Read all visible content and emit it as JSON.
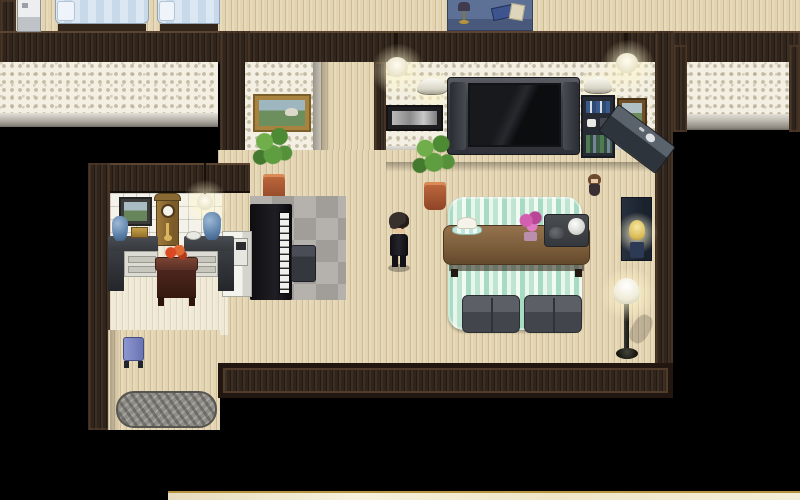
{
  "app": {
    "type": "rpg-maker-style game screenshot",
    "view": "top-down interior of a house, player character standing in living room",
    "visible_text": "none"
  },
  "palette": {
    "void": "#000000",
    "wood_floor": "#e4d5b2",
    "pale_floor": "#efe8d4",
    "dark_wall": "#31241a",
    "mosaic_tile": "#f3efe2",
    "white_tile": "#f4f2ea",
    "rug_green": "#bfe4d0",
    "rug_gray": "#8f8d87",
    "marble": "#f2ebd5",
    "lamp_glow": "#fff7cd",
    "bed_blue": "#d8e5f0",
    "bench_blue": "#7b85c4",
    "table_brown": "#7d5f3f",
    "flower_pink": "#d35fb0"
  },
  "rooms": {
    "top_bedroom": {
      "name": "bedroom strip (top edge)",
      "furniture": [
        "refrigerator",
        "bed",
        "bed",
        "blue desk with lamp and books"
      ]
    },
    "living_room": {
      "name": "living room",
      "furniture": [
        "pendant lamp",
        "pendant lamp",
        "wall sconce",
        "wall sconce",
        "panoramic picture",
        "widescreen tv",
        "bookshelf",
        "framed picture",
        "potted plant",
        "green striped rug",
        "low table",
        "cake plate",
        "pink flowers",
        "tea tray with kettle",
        "floor cushion",
        "floor cushion",
        "doll",
        "sink counter",
        "dresser with lamp",
        "floor lamp"
      ]
    },
    "piano_room": {
      "name": "piano nook",
      "furniture": [
        "landscape painting",
        "potted plant",
        "gray diamond rug",
        "upright piano",
        "chair",
        "white cabinet with intercom"
      ]
    },
    "study": {
      "name": "study with clock",
      "furniture": [
        "framed picture",
        "grandfather clock",
        "hanging lamp",
        "corner desk left",
        "corner desk right",
        "blue vase",
        "gold box",
        "plate",
        "blue vase",
        "small table with red flowers"
      ]
    },
    "corridor": {
      "name": "corridor (bottom left)",
      "furniture": [
        "blue bench",
        "gray shag rug"
      ]
    },
    "right_room": {
      "name": "dark room (right, unlit)",
      "furniture": []
    },
    "bottom_room": {
      "name": "room below (marble floor sliver)",
      "furniture": []
    }
  },
  "player": {
    "description": "small sprite, dark shaggy hair, black outfit, standing on wood floor",
    "position_px": {
      "x": 385,
      "y": 210
    }
  }
}
